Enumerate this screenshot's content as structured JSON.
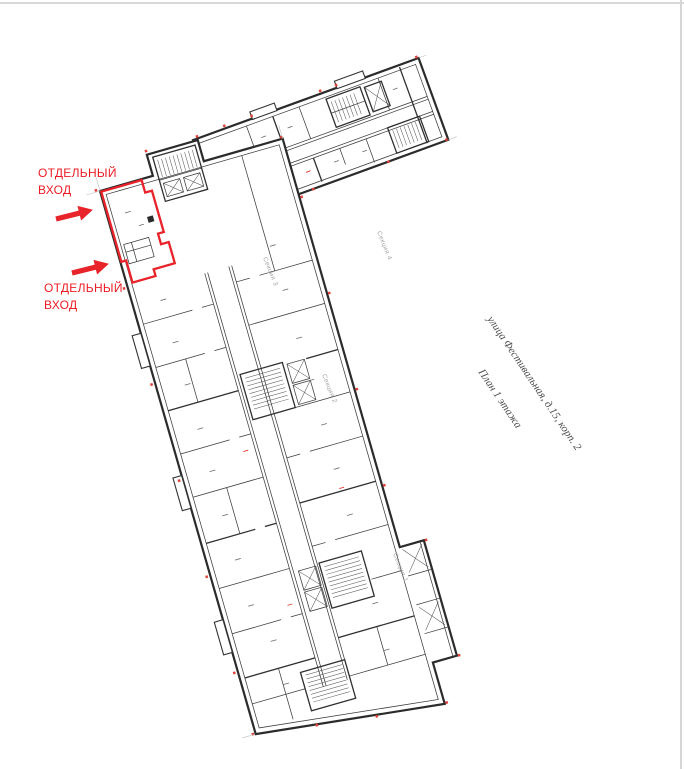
{
  "page": {
    "type": "architectural floor plan drawing",
    "background": "#ffffff",
    "border_color": "#d8d8d8"
  },
  "entrance_labels": [
    {
      "line1": "ОТДЕЛЬНЫЙ",
      "line2": "ВХОД"
    },
    {
      "line1": "ОТДЕЛЬНЫЙ",
      "line2": "ВХОД"
    }
  ],
  "title_block": {
    "address": "улица Фестивальная, д.15, корп. 2",
    "plan": "План 1 этажа"
  },
  "section_labels": [
    {
      "label": "Секция 1"
    },
    {
      "label": "Секция 2"
    },
    {
      "label": "Секция 3"
    },
    {
      "label": "Секция 4"
    }
  ],
  "colors": {
    "highlight_outline": "#e8232a",
    "annotation_text": "#ed1c24",
    "linework": "#2f2f2f",
    "section_label": "#a5a5a5",
    "title_text": "#4d4d4d"
  }
}
